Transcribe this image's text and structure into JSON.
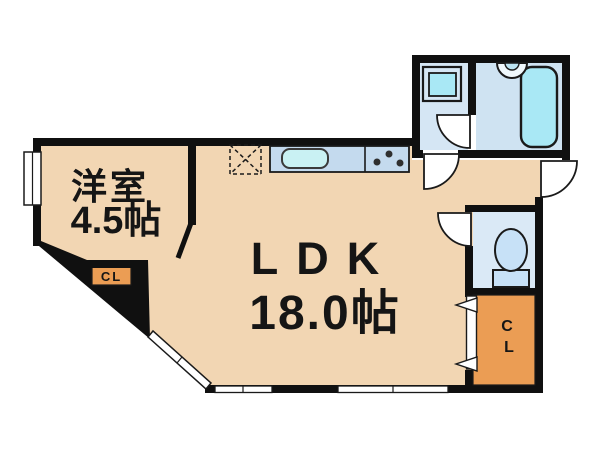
{
  "floorplan": {
    "kind": "japanese-apartment-floor-plan",
    "rooms": {
      "western_room": {
        "name": "洋室",
        "size": "4.5帖"
      },
      "ldk": {
        "name": "LDK",
        "size": "18.0帖"
      },
      "closet_left": {
        "label": "CL"
      },
      "closet_right": {
        "letter1": "C",
        "letter2": "L"
      }
    },
    "icons": {
      "refrigerator_space": "dashed square with X",
      "kitchen_sink": "rounded rectangle basin",
      "stove": "three burner dots",
      "washing_machine": "double square",
      "wash_basin": "half circle on wall",
      "bathtub": "rounded rectangle tub",
      "toilet": "bowl with tank base"
    },
    "colors": {
      "wall": "#101010",
      "floor": "#F2D6B3",
      "closet": "#EB9D54",
      "washroom_floor": "#D5E6F4",
      "bathroom_floor": "#CFE3F2",
      "toilet_floor": "#DAE9F6",
      "kitchen_counter": "#C4DAEE",
      "water_cyan": "#A9E8F5",
      "sink_cyan": "#C9F1F3",
      "toilet_fixture": "#C7E1F7",
      "closet_right_text": "#5C4322",
      "closet_left_text": "#222222"
    }
  }
}
